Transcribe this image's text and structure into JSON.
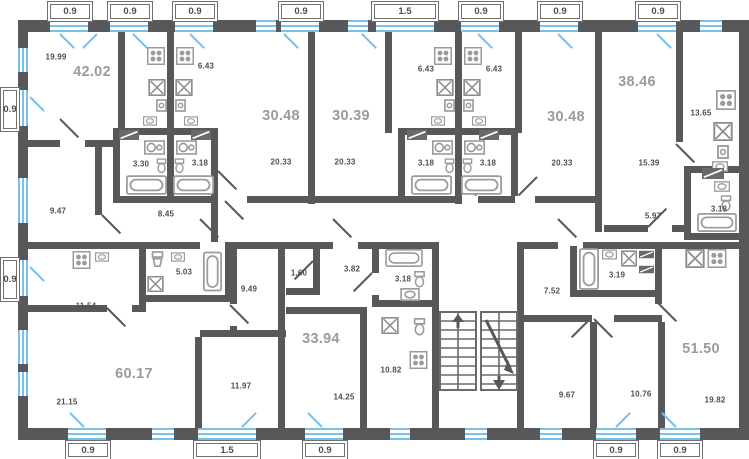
{
  "plan_title": "Typical floor plan",
  "apartments": [
    {
      "total": "42.02",
      "rooms": [
        {
          "name": "living-room",
          "area": "19.99"
        },
        {
          "name": "bedroom",
          "area": "9.47"
        },
        {
          "name": "bathroom",
          "area": "3.30"
        },
        {
          "name": "hallway",
          "area": "8.45"
        }
      ]
    },
    {
      "total": "30.48",
      "rooms": [
        {
          "name": "living-room",
          "area": "20.33"
        },
        {
          "name": "kitchen",
          "area": "6.43"
        },
        {
          "name": "bathroom",
          "area": "3.18"
        }
      ]
    },
    {
      "total": "30.39",
      "rooms": [
        {
          "name": "living-room",
          "area": "20.33"
        },
        {
          "name": "kitchen",
          "area": "6.43"
        },
        {
          "name": "bathroom",
          "area": "3.18"
        }
      ]
    },
    {
      "total": "30.48",
      "rooms": [
        {
          "name": "living-room",
          "area": "20.33"
        },
        {
          "name": "kitchen",
          "area": "6.43"
        },
        {
          "name": "bathroom",
          "area": "3.18"
        }
      ]
    },
    {
      "total": "38.46",
      "rooms": [
        {
          "name": "living-room",
          "area": "15.39"
        },
        {
          "name": "kitchen",
          "area": "13.65"
        },
        {
          "name": "hallway",
          "area": "5.97"
        },
        {
          "name": "bathroom",
          "area": "3.18"
        }
      ]
    },
    {
      "total": "60.17",
      "rooms": [
        {
          "name": "kitchen",
          "area": "11.54"
        },
        {
          "name": "bathroom",
          "area": "5.03"
        },
        {
          "name": "bedroom",
          "area": "9.49"
        },
        {
          "name": "living-room",
          "area": "21.15"
        },
        {
          "name": "bedroom-2",
          "area": "11.97"
        }
      ]
    },
    {
      "total": "33.94",
      "rooms": [
        {
          "name": "closet",
          "area": "1.60"
        },
        {
          "name": "hallway",
          "area": "3.82"
        },
        {
          "name": "bathroom",
          "area": "3.18"
        },
        {
          "name": "living-room",
          "area": "14.25"
        },
        {
          "name": "kitchen",
          "area": "10.82"
        }
      ]
    },
    {
      "total": "51.50",
      "rooms": [
        {
          "name": "hallway",
          "area": "7.52"
        },
        {
          "name": "bathroom",
          "area": "3.19"
        },
        {
          "name": "bedroom",
          "area": "9.67"
        },
        {
          "name": "bedroom-2",
          "area": "10.76"
        },
        {
          "name": "kitchen-living",
          "area": "19.82"
        }
      ]
    }
  ],
  "window_dimensions": {
    "top": [
      "0.9",
      "0.9",
      "0.9",
      "0.9",
      "1.5",
      "0.9",
      "0.9",
      "0.9"
    ],
    "bottom": [
      "0.9",
      "1.5",
      "0.9",
      "0.9",
      "0.9"
    ],
    "left": [
      "0.9",
      "0.9"
    ]
  },
  "colors": {
    "wall": "#58585a",
    "window": "#79c1e8",
    "fixture": "#9b9b9d",
    "room_label": "#4e4e50",
    "apartment_label": "#9b9b9d"
  }
}
